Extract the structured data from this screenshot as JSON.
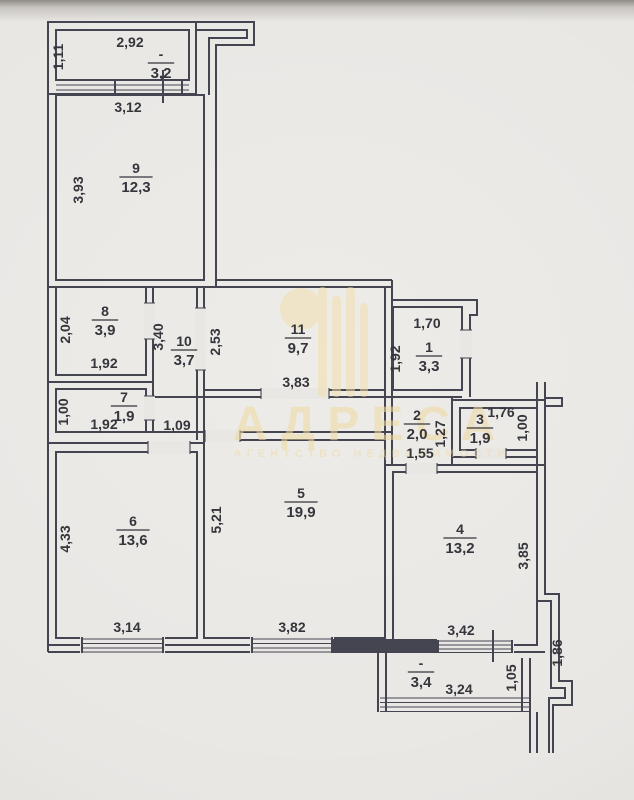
{
  "page": {
    "background": "#e9e7e4",
    "wall_color": "#454551",
    "text_color": "#35353c"
  },
  "watermark": {
    "title": "АДРЕСА",
    "subtitle": "АГЕНТСТВО НЕДВИЖИМОСТИ",
    "color": "#efdca6"
  },
  "rooms": [
    {
      "number": "-",
      "area": "3,2",
      "cx": 161,
      "cy": 63
    },
    {
      "number": "9",
      "area": "12,3",
      "cx": 136,
      "cy": 177
    },
    {
      "number": "8",
      "area": "3,9",
      "cx": 105,
      "cy": 320
    },
    {
      "number": "10",
      "area": "3,7",
      "cx": 184,
      "cy": 350
    },
    {
      "number": "11",
      "area": "9,7",
      "cx": 298,
      "cy": 338
    },
    {
      "number": "1",
      "area": "3,3",
      "cx": 429,
      "cy": 356
    },
    {
      "number": "7",
      "area": "1,9",
      "cx": 124,
      "cy": 406
    },
    {
      "number": "2",
      "area": "2,0",
      "cx": 417,
      "cy": 424
    },
    {
      "number": "3",
      "area": "1,9",
      "cx": 480,
      "cy": 428
    },
    {
      "number": "6",
      "area": "13,6",
      "cx": 133,
      "cy": 530
    },
    {
      "number": "5",
      "area": "19,9",
      "cx": 301,
      "cy": 502
    },
    {
      "number": "4",
      "area": "13,2",
      "cx": 460,
      "cy": 538
    },
    {
      "number": "-",
      "area": "3,4",
      "cx": 421,
      "cy": 672
    }
  ],
  "dims": [
    {
      "t": "2,92",
      "x": 130,
      "y": 47,
      "r": 0
    },
    {
      "t": "1,11",
      "x": 63,
      "y": 57,
      "r": 1
    },
    {
      "t": "3,12",
      "x": 128,
      "y": 112,
      "r": 0
    },
    {
      "t": "3,93",
      "x": 83,
      "y": 190,
      "r": 1
    },
    {
      "t": "2,04",
      "x": 70,
      "y": 330,
      "r": 1
    },
    {
      "t": "1,92",
      "x": 104,
      "y": 368,
      "r": 0
    },
    {
      "t": "3,40",
      "x": 163,
      "y": 337,
      "r": 1
    },
    {
      "t": "2,53",
      "x": 220,
      "y": 342,
      "r": 1
    },
    {
      "t": "3,83",
      "x": 296,
      "y": 387,
      "r": 0
    },
    {
      "t": "1,70",
      "x": 427,
      "y": 328,
      "r": 0
    },
    {
      "t": "1,92",
      "x": 400,
      "y": 359,
      "r": 1
    },
    {
      "t": "1,00",
      "x": 68,
      "y": 412,
      "r": 1
    },
    {
      "t": "1,92",
      "x": 104,
      "y": 429,
      "r": 0
    },
    {
      "t": "1,09",
      "x": 177,
      "y": 430,
      "r": 0
    },
    {
      "t": "1,27",
      "x": 445,
      "y": 434,
      "r": 1
    },
    {
      "t": "1,55",
      "x": 420,
      "y": 458,
      "r": 0
    },
    {
      "t": "1,76",
      "x": 501,
      "y": 417,
      "r": 0
    },
    {
      "t": "1,00",
      "x": 527,
      "y": 428,
      "r": 1
    },
    {
      "t": "4,33",
      "x": 70,
      "y": 539,
      "r": 1
    },
    {
      "t": "3,14",
      "x": 127,
      "y": 632,
      "r": 0
    },
    {
      "t": "5,21",
      "x": 221,
      "y": 520,
      "r": 1
    },
    {
      "t": "3,82",
      "x": 292,
      "y": 632,
      "r": 0
    },
    {
      "t": "3,85",
      "x": 528,
      "y": 556,
      "r": 1
    },
    {
      "t": "3,42",
      "x": 461,
      "y": 635,
      "r": 0
    },
    {
      "t": "3,24",
      "x": 459,
      "y": 694,
      "r": 0
    },
    {
      "t": "1,05",
      "x": 516,
      "y": 678,
      "r": 1
    },
    {
      "t": "1,86",
      "x": 562,
      "y": 653,
      "r": 1
    }
  ]
}
